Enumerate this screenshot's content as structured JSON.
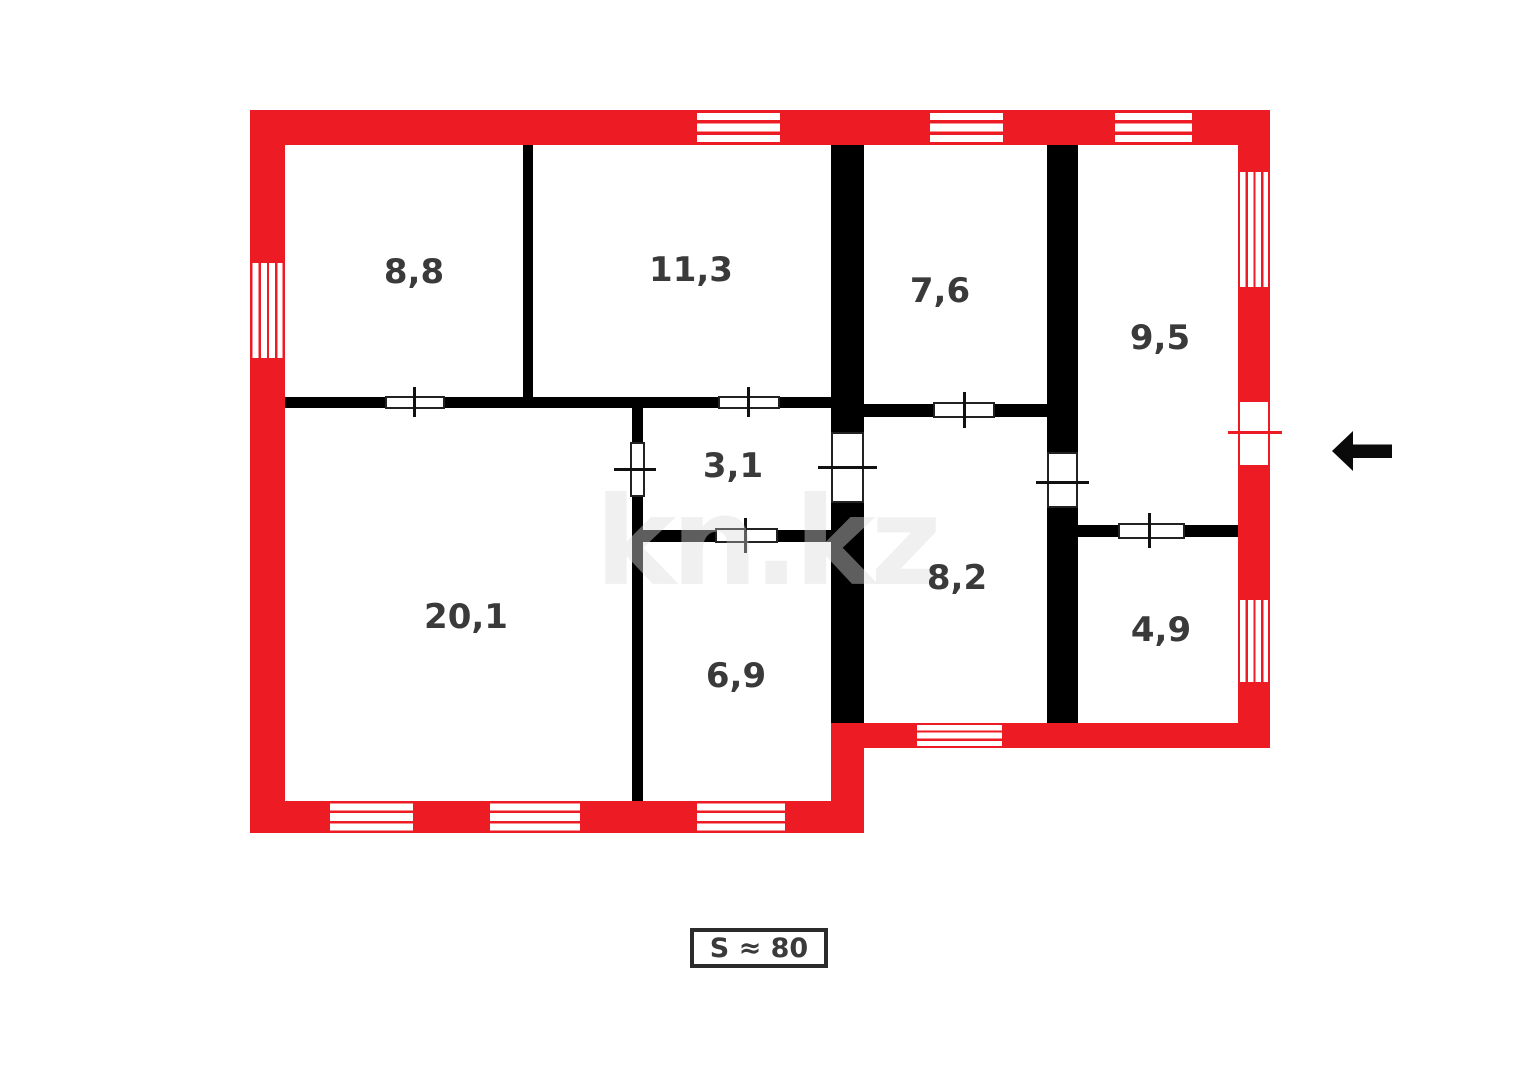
{
  "plan": {
    "watermark": "kn.kz",
    "total_area": {
      "label": "S ≈ 80"
    },
    "rooms": [
      {
        "name": "room-8-8",
        "label": "8,8",
        "area": 8.8
      },
      {
        "name": "room-11-3",
        "label": "11,3",
        "area": 11.3
      },
      {
        "name": "room-7-6",
        "label": "7,6",
        "area": 7.6
      },
      {
        "name": "room-9-5",
        "label": "9,5",
        "area": 9.5
      },
      {
        "name": "room-3-1",
        "label": "3,1",
        "area": 3.1
      },
      {
        "name": "room-20-1",
        "label": "20,1",
        "area": 20.1
      },
      {
        "name": "room-6-9",
        "label": "6,9",
        "area": 6.9
      },
      {
        "name": "room-8-2",
        "label": "8,2",
        "area": 8.2
      },
      {
        "name": "room-4-9",
        "label": "4,9",
        "area": 4.9
      }
    ],
    "icons": {
      "entrance_arrow": "left-arrow-icon"
    },
    "colors": {
      "outer_wall": "#ed1c24",
      "inner_wall": "#000000",
      "label_text": "#3a3a3a"
    }
  }
}
